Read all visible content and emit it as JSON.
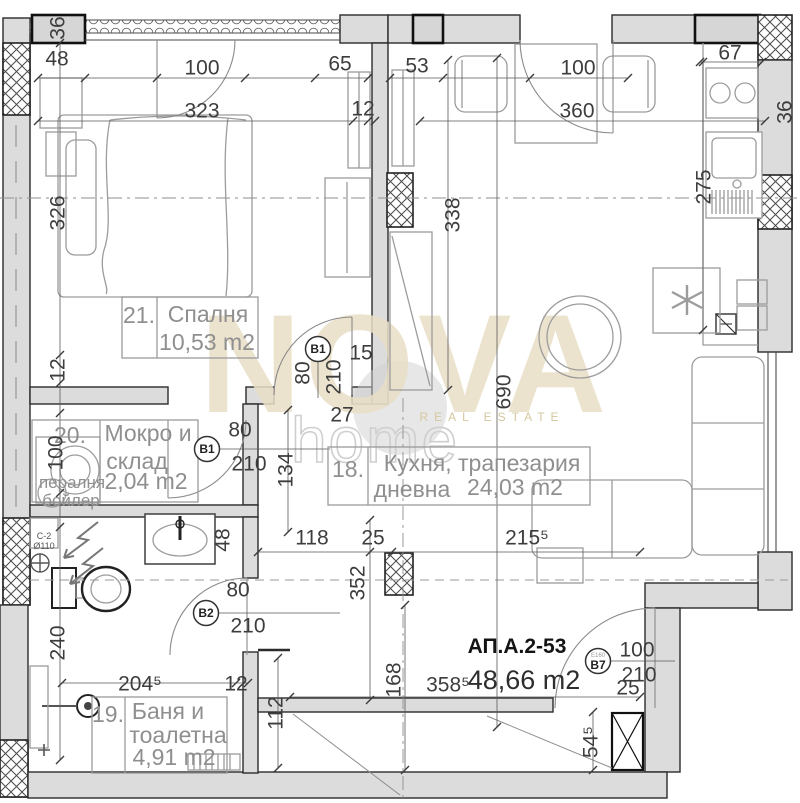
{
  "watermark": {
    "brand": "NOVA",
    "word": "home",
    "tagline": "REAL ESTATE"
  },
  "apartment": {
    "code": "АП.А.2-53",
    "area": "48,66 m2"
  },
  "rooms": [
    {
      "num": "21.",
      "line1": "Спалня",
      "line2": "",
      "area": "10,53 m2"
    },
    {
      "num": "20.",
      "line1": "Мокро и",
      "line2": "склад",
      "area": "2,04 m2"
    },
    {
      "num": "18.",
      "line1": "Кухня, трапезария",
      "line2": "дневна",
      "area": "24,03 m2"
    },
    {
      "num": "19.",
      "line1": "Баня и",
      "line2": "тоалетна",
      "area": "4,91 m2"
    }
  ],
  "door_markers": [
    {
      "label": "B1",
      "sub": "",
      "x": 318,
      "y": 349
    },
    {
      "label": "B1",
      "sub": "",
      "x": 207,
      "y": 449
    },
    {
      "label": "B2",
      "sub": "",
      "x": 206,
      "y": 613
    },
    {
      "label": "B7",
      "sub": "Е160",
      "x": 598,
      "y": 661
    }
  ],
  "dimensions": [
    {
      "t": "48",
      "x": 57,
      "y": 58,
      "rot": false
    },
    {
      "t": "100",
      "x": 202,
      "y": 67,
      "rot": false
    },
    {
      "t": "323",
      "x": 202,
      "y": 110,
      "rot": false
    },
    {
      "t": "65",
      "x": 340,
      "y": 63,
      "rot": false
    },
    {
      "t": "12",
      "x": 363,
      "y": 108,
      "rot": false
    },
    {
      "t": "53",
      "x": 417,
      "y": 65,
      "rot": false
    },
    {
      "t": "100",
      "x": 578,
      "y": 67,
      "rot": false
    },
    {
      "t": "360",
      "x": 577,
      "y": 110,
      "rot": false
    },
    {
      "t": "67",
      "x": 730,
      "y": 52,
      "rot": false
    },
    {
      "t": "15",
      "x": 361,
      "y": 352,
      "rot": false
    },
    {
      "t": "27",
      "x": 342,
      "y": 414,
      "rot": false
    },
    {
      "t": "80",
      "x": 240,
      "y": 429,
      "rot": false
    },
    {
      "t": "210",
      "x": 249,
      "y": 463,
      "rot": false
    },
    {
      "t": "118",
      "x": 312,
      "y": 537,
      "rot": false
    },
    {
      "t": "25",
      "x": 373,
      "y": 537,
      "rot": false
    },
    {
      "t": "215⁵",
      "x": 527,
      "y": 537,
      "rot": false
    },
    {
      "t": "80",
      "x": 238,
      "y": 589,
      "rot": false
    },
    {
      "t": "210",
      "x": 248,
      "y": 625,
      "rot": false
    },
    {
      "t": "204⁵",
      "x": 140,
      "y": 683,
      "rot": false
    },
    {
      "t": "12",
      "x": 236,
      "y": 683,
      "rot": false
    },
    {
      "t": "100",
      "x": 637,
      "y": 649,
      "rot": false
    },
    {
      "t": "210",
      "x": 639,
      "y": 674,
      "rot": false
    },
    {
      "t": "25",
      "x": 628,
      "y": 687,
      "rot": false
    },
    {
      "t": "358⁵",
      "x": 448,
      "y": 684,
      "rot": false
    },
    {
      "t": "36",
      "x": 57,
      "y": 28,
      "rot": true
    },
    {
      "t": "326",
      "x": 57,
      "y": 213,
      "rot": true
    },
    {
      "t": "12",
      "x": 57,
      "y": 370,
      "rot": true
    },
    {
      "t": "100",
      "x": 55,
      "y": 453,
      "rot": true
    },
    {
      "t": "240",
      "x": 57,
      "y": 643,
      "rot": true
    },
    {
      "t": "275",
      "x": 703,
      "y": 187,
      "rot": true
    },
    {
      "t": "36",
      "x": 784,
      "y": 112,
      "rot": true
    },
    {
      "t": "338",
      "x": 452,
      "y": 215,
      "rot": true
    },
    {
      "t": "690",
      "x": 503,
      "y": 392,
      "rot": true
    },
    {
      "t": "80",
      "x": 302,
      "y": 373,
      "rot": true
    },
    {
      "t": "210",
      "x": 333,
      "y": 377,
      "rot": true
    },
    {
      "t": "134",
      "x": 285,
      "y": 470,
      "rot": true
    },
    {
      "t": "48",
      "x": 222,
      "y": 540,
      "rot": true
    },
    {
      "t": "352",
      "x": 357,
      "y": 583,
      "rot": true
    },
    {
      "t": "168",
      "x": 393,
      "y": 680,
      "rot": true
    },
    {
      "t": "112",
      "x": 275,
      "y": 713,
      "rot": true
    },
    {
      "t": "54⁵",
      "x": 590,
      "y": 742,
      "rot": true
    }
  ],
  "equipment_labels": [
    {
      "t": "пералня",
      "x": 72,
      "y": 482
    },
    {
      "t": "бойлер",
      "x": 71,
      "y": 500
    }
  ],
  "pipe_labels": [
    {
      "t": "С-2",
      "x": 44,
      "y": 536
    },
    {
      "t": "Ø110",
      "x": 44,
      "y": 546
    }
  ]
}
